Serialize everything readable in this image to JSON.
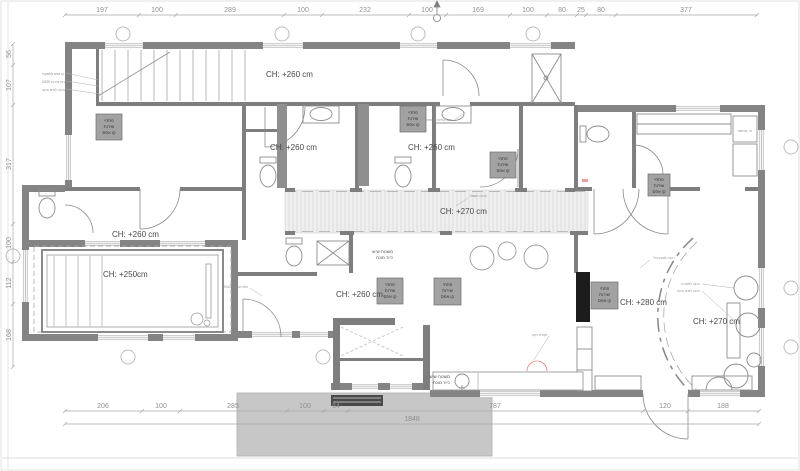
{
  "dimensions": {
    "top": [
      "197",
      "100",
      "289",
      "100",
      "232",
      "100",
      "169",
      "100",
      "80",
      "25",
      "80",
      "377"
    ],
    "left": [
      "56",
      "107",
      "317",
      "100",
      "112",
      "168"
    ],
    "bottom": [
      "206",
      "100",
      "285",
      "100",
      "64",
      "787",
      "120",
      "188"
    ],
    "overall": "1848"
  },
  "ceiling_labels": [
    "CH: +260 cm",
    "CH: +260 cm",
    "CH: +260 cm",
    "CH: +270 cm",
    "CH: +260 cm",
    "CH: +250cm",
    "CH: +260 cm",
    "CH: +280 cm",
    "CH: +270 cm"
  ],
  "service_box": {
    "lines": [
      "פתחי",
      "שירות",
      "קו אפס"
    ]
  },
  "counter_label": {
    "lines": [
      "משטח שיש",
      "כיור מונח"
    ]
  },
  "laundry_label": "ח. כביסה",
  "annotations": [
    "קו אפס למשקוף",
    "פתח שירות 20/20",
    "הכנה למים וניקוז",
    "הכנת חשמל",
    "הכנה למזגן עילי",
    "פתח שירות קו אפס",
    "נקודת ניקוז",
    "הכנה לתאורה"
  ],
  "colors": {
    "wall": "#848484",
    "partition": "#7e7e7e",
    "deck": "#c7c7c7",
    "service_box_fill": "#a2a2a2",
    "black_wall": "#1c1c1c",
    "red_accent": "#e8837a",
    "dim_text": "#8f8f8f"
  }
}
